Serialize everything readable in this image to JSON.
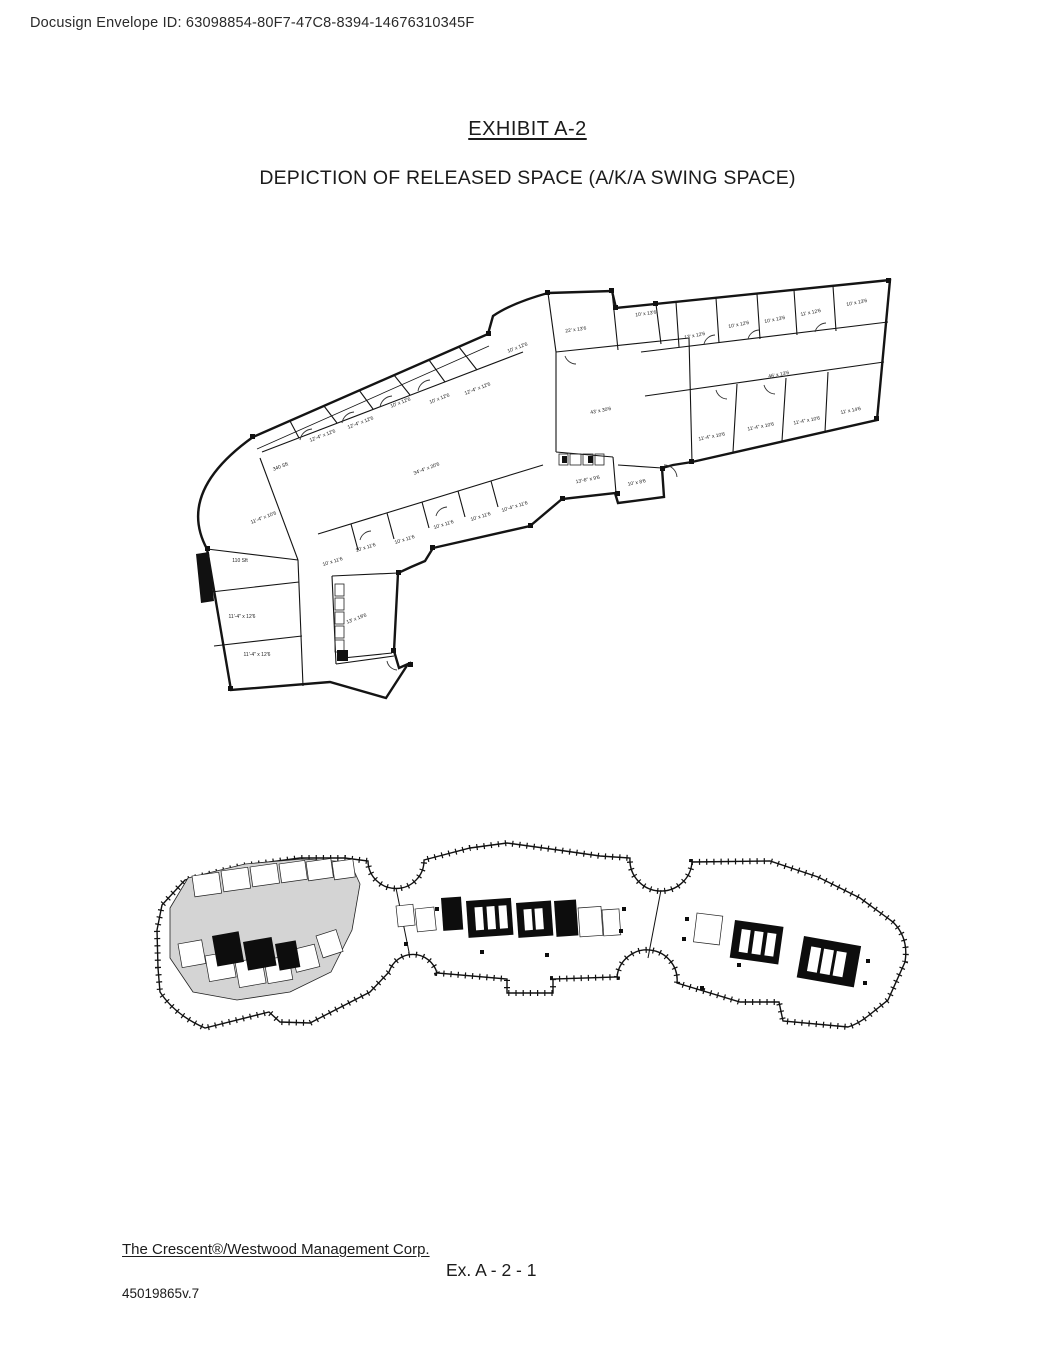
{
  "header": {
    "envelope_line": "Docusign Envelope ID: 63098854-80F7-47C8-8394-14676310345F"
  },
  "title": "EXHIBIT A-2",
  "subtitle": "DEPICTION OF RELEASED SPACE (A/K/A SWING SPACE)",
  "plan_detail": {
    "description": "Detailed floor plan of released (swing) space",
    "room_labels": [
      {
        "t": "340 Sft",
        "x": 281,
        "y": 468,
        "r": -21
      },
      {
        "t": "12'-4\" x 12'6",
        "x": 323,
        "y": 437,
        "r": -21
      },
      {
        "t": "12'-4\" x 12'6",
        "x": 361,
        "y": 424,
        "r": -21
      },
      {
        "t": "10' x 12'6",
        "x": 401,
        "y": 404,
        "r": -21
      },
      {
        "t": "10' x 12'6",
        "x": 440,
        "y": 400,
        "r": -21
      },
      {
        "t": "12'-4\" x 12'6",
        "x": 478,
        "y": 390,
        "r": -21
      },
      {
        "t": "10' x 12'6",
        "x": 518,
        "y": 349,
        "r": -21
      },
      {
        "t": "22' x 13'6",
        "x": 576,
        "y": 331,
        "r": -8
      },
      {
        "t": "10' x 13'6",
        "x": 646,
        "y": 315,
        "r": -8
      },
      {
        "t": "13' x 12'6",
        "x": 695,
        "y": 337,
        "r": -11
      },
      {
        "t": "10' x 12'6",
        "x": 739,
        "y": 326,
        "r": -11
      },
      {
        "t": "10' x 13'6",
        "x": 775,
        "y": 321,
        "r": -11
      },
      {
        "t": "11' x 12'6",
        "x": 811,
        "y": 314,
        "r": -11
      },
      {
        "t": "10' x 13'6",
        "x": 857,
        "y": 304,
        "r": -11
      },
      {
        "t": "46' x 13'6",
        "x": 779,
        "y": 376,
        "r": -11
      },
      {
        "t": "11'-4\" x 10'6",
        "x": 712,
        "y": 438,
        "r": -11
      },
      {
        "t": "11'-4\" x 10'6",
        "x": 761,
        "y": 428,
        "r": -11
      },
      {
        "t": "11'-4\" x 10'6",
        "x": 807,
        "y": 422,
        "r": -11
      },
      {
        "t": "11' x 14'6",
        "x": 851,
        "y": 412,
        "r": -11
      },
      {
        "t": "43' x 30'6",
        "x": 601,
        "y": 412,
        "r": -11
      },
      {
        "t": "34'-4\" x 20'6",
        "x": 427,
        "y": 470,
        "r": -21
      },
      {
        "t": "13'-6\" x 9'6",
        "x": 588,
        "y": 481,
        "r": -11
      },
      {
        "t": "10' x 8'6",
        "x": 637,
        "y": 484,
        "r": -11
      },
      {
        "t": "10' x 11'6",
        "x": 333,
        "y": 563,
        "r": -17
      },
      {
        "t": "10' x 11'6",
        "x": 366,
        "y": 549,
        "r": -17
      },
      {
        "t": "10' x 11'6",
        "x": 405,
        "y": 541,
        "r": -17
      },
      {
        "t": "10' x 11'6",
        "x": 444,
        "y": 526,
        "r": -17
      },
      {
        "t": "10' x 11'6",
        "x": 481,
        "y": 518,
        "r": -17
      },
      {
        "t": "10'-4\" x 11'6",
        "x": 515,
        "y": 508,
        "r": -17
      },
      {
        "t": "11'-4\" x 10'6",
        "x": 264,
        "y": 519,
        "r": -21
      },
      {
        "t": "110 Sft",
        "x": 240,
        "y": 562,
        "r": 0
      },
      {
        "t": "11'-4\" x 12'6",
        "x": 242,
        "y": 618,
        "r": 0
      },
      {
        "t": "11'-4\" x 12'6",
        "x": 257,
        "y": 656,
        "r": 0
      },
      {
        "t": "13' x 19'6",
        "x": 357,
        "y": 620,
        "r": -21
      }
    ]
  },
  "plan_key": {
    "description": "Full-floor key plan with released space highlighted",
    "highlight_color": "#d4d4d4"
  },
  "footer": {
    "company_line": "The Crescent®/Westwood Management Corp.",
    "exhibit_ref": "Ex. A - 2 - 1",
    "doc_version": "45019865v.7"
  },
  "colors": {
    "ink": "#141414",
    "paper": "#ffffff"
  }
}
